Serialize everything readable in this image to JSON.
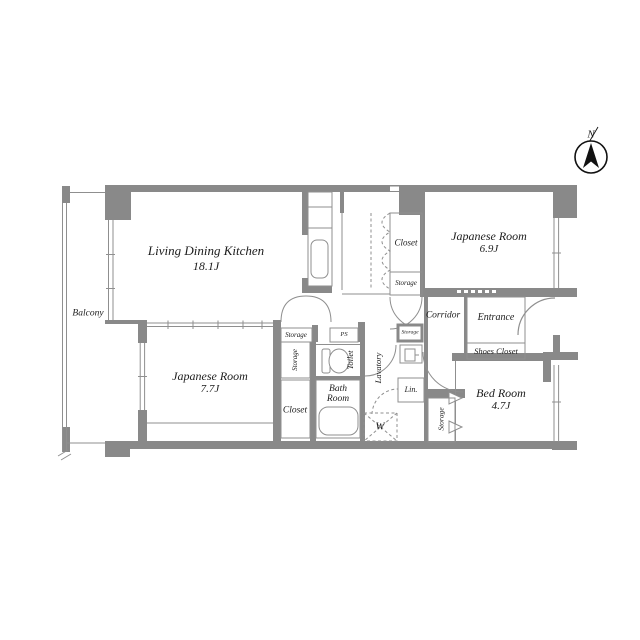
{
  "compass": {
    "north_label": "N"
  },
  "rooms": {
    "living_dining_kitchen": {
      "name": "Living Dining Kitchen",
      "size": "18.1J"
    },
    "japanese_room_east": {
      "name": "Japanese Room",
      "size": "6.9J"
    },
    "japanese_room_west": {
      "name": "Japanese Room",
      "size": "7.7J"
    },
    "bed_room": {
      "name": "Bed Room",
      "size": "4.7J"
    },
    "balcony": {
      "name": "Balcony"
    },
    "entrance": {
      "name": "Entrance"
    },
    "shoes_closet": {
      "name": "Shoes Closet"
    },
    "corridor": {
      "name": "Corridor"
    },
    "closet_north": {
      "name": "Closet"
    },
    "storage_north": {
      "name": "Storage"
    },
    "storage_mid": {
      "name": "Storage"
    },
    "pipe_space": {
      "name": "PS"
    },
    "storage_west": {
      "name": "Storage"
    },
    "toilet": {
      "name": "Toilet"
    },
    "closet_south": {
      "name": "Closet"
    },
    "bath_room": {
      "name": "Bath Room"
    },
    "lavatory": {
      "name": "Lavatory"
    },
    "linen": {
      "name": "Lin."
    },
    "washing_machine": {
      "name": "W"
    },
    "storage_corridor": {
      "name": "Storage"
    },
    "storage_bedroom": {
      "name": "Storage"
    }
  },
  "colors": {
    "wall": "#898989",
    "line": "#8f8f8f",
    "text": "#1c1c1c",
    "dark": "#111111"
  }
}
